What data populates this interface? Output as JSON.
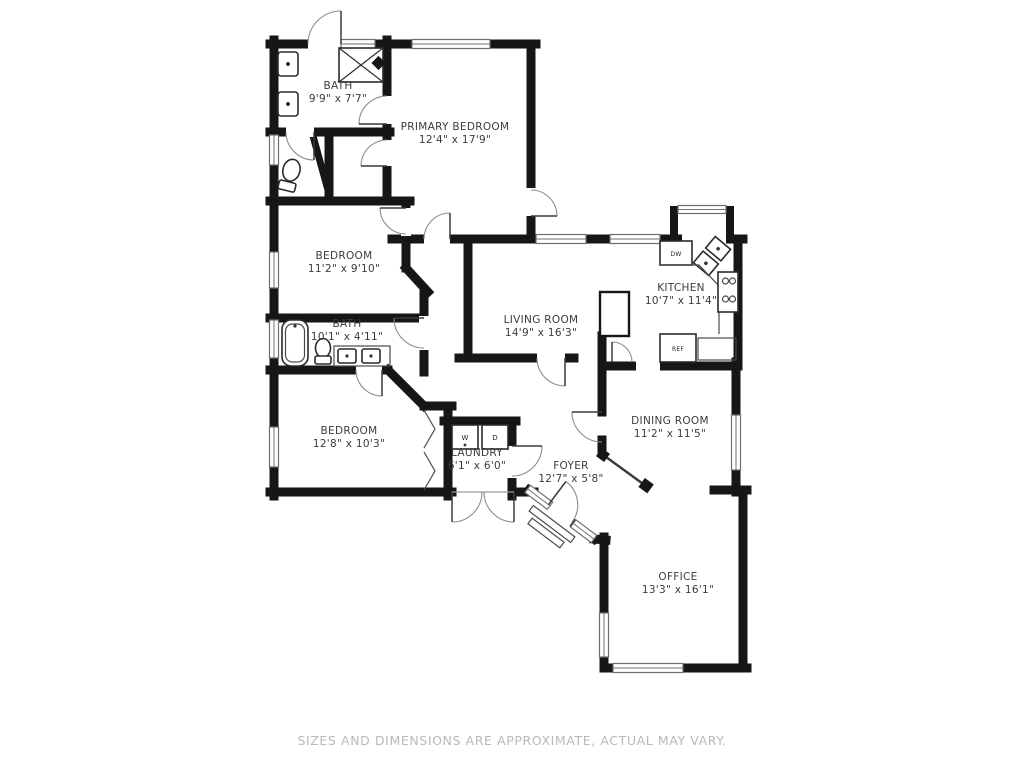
{
  "title": "Floor plan",
  "disclaimer": "SIZES AND DIMENSIONS ARE APPROXIMATE, ACTUAL MAY VARY.",
  "colors": {
    "wall": "#161616",
    "label": "#3c3c3c",
    "disclaimer_text": "#b9b9b9",
    "background": "#ffffff"
  },
  "rooms": [
    {
      "id": "bath-1",
      "name": "BATH",
      "dims": "9'9\" x 7'7\"",
      "label_x": 338,
      "label_y": 89
    },
    {
      "id": "primary-bedroom",
      "name": "PRIMARY BEDROOM",
      "dims": "12'4\" x 17'9\"",
      "label_x": 455,
      "label_y": 130
    },
    {
      "id": "bedroom-2",
      "name": "BEDROOM",
      "dims": "11'2\" x 9'10\"",
      "label_x": 344,
      "label_y": 259
    },
    {
      "id": "bath-2",
      "name": "BATH",
      "dims": "10'1\" x 4'11\"",
      "label_x": 347,
      "label_y": 327
    },
    {
      "id": "bedroom-3",
      "name": "BEDROOM",
      "dims": "12'8\" x 10'3\"",
      "label_x": 349,
      "label_y": 434
    },
    {
      "id": "laundry",
      "name": "LAUNDRY",
      "dims": "6'1\" x 6'0\"",
      "label_x": 477,
      "label_y": 456
    },
    {
      "id": "living-room",
      "name": "LIVING ROOM",
      "dims": "14'9\" x 16'3\"",
      "label_x": 541,
      "label_y": 323
    },
    {
      "id": "kitchen",
      "name": "KITCHEN",
      "dims": "10'7\" x 11'4\"",
      "label_x": 681,
      "label_y": 291
    },
    {
      "id": "dining-room",
      "name": "DINING ROOM",
      "dims": "11'2\" x 11'5\"",
      "label_x": 670,
      "label_y": 424
    },
    {
      "id": "foyer",
      "name": "FOYER",
      "dims": "12'7\" x 5'8\"",
      "label_x": 571,
      "label_y": 469
    },
    {
      "id": "office",
      "name": "OFFICE",
      "dims": "13'3\" x 16'1\"",
      "label_x": 678,
      "label_y": 580
    }
  ],
  "appliances": {
    "washer": "W",
    "dryer": "D",
    "dishwasher": "DW",
    "refrigerator": "REF"
  }
}
